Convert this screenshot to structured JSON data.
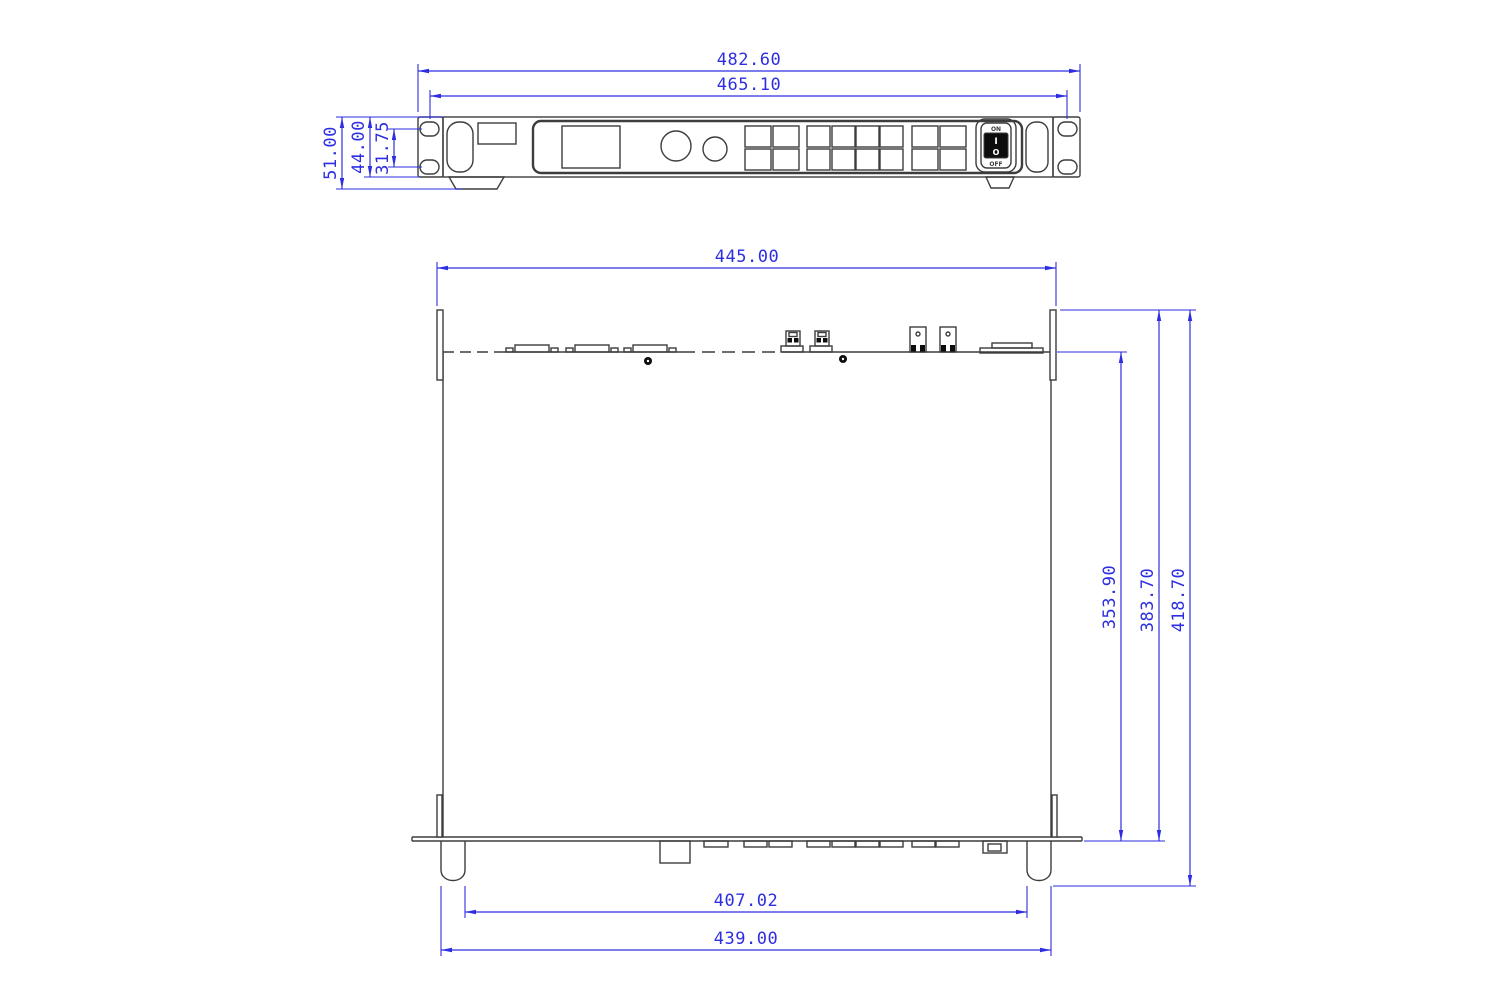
{
  "front_view": {
    "dim_overall_width": "482.60",
    "dim_mounting_width": "465.10",
    "dim_overall_height": "51.00",
    "dim_chassis_height": "44.00",
    "dim_hole_spacing": "31.75",
    "power_switch": {
      "on_label": "ON",
      "off_label": "OFF",
      "rocker_on_symbol": "I",
      "rocker_off_symbol": "O"
    }
  },
  "top_view": {
    "dim_rear_width": "445.00",
    "dim_body_depth": "353.90",
    "dim_depth_with_rear": "383.70",
    "dim_overall_depth": "418.70",
    "dim_feet_inner_width": "407.02",
    "dim_chassis_width": "439.00"
  },
  "colors": {
    "line": "#3d3d3d",
    "dimension": "#2e2ee0",
    "background": "#ffffff"
  }
}
